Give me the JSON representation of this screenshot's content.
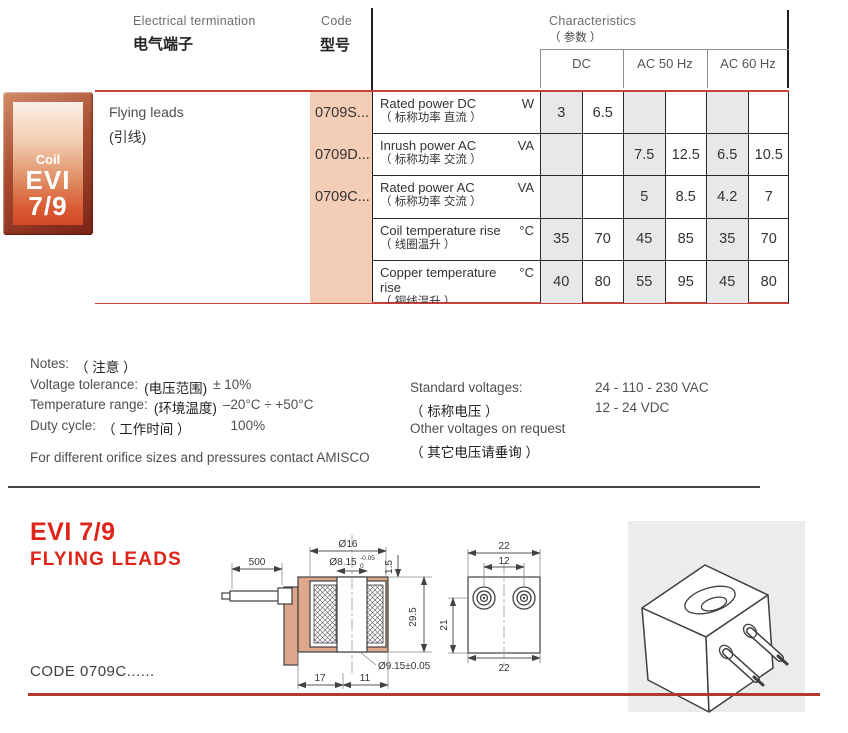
{
  "header": {
    "electrical_termination_en": "Electrical termination",
    "electrical_termination_zh": "电气端子",
    "code_en": "Code",
    "code_zh": "型号",
    "characteristics_en": "Characteristics",
    "characteristics_zh": "（ 参数 ）",
    "columns": [
      "DC",
      "AC 50 Hz",
      "AC 60 Hz"
    ]
  },
  "badge": {
    "line1": "Coil",
    "line2": "EVI",
    "line3": "7/9"
  },
  "table": {
    "termination_en": "Flying leads",
    "termination_zh": "(引线)",
    "codes": [
      "0709S...",
      "0709D...",
      "0709C..."
    ],
    "rows": [
      {
        "en": "Rated power DC",
        "zh": "（ 标称功率 直流 ）",
        "unit": "W",
        "values": [
          "3",
          "6.5",
          "",
          "",
          "",
          ""
        ]
      },
      {
        "en": "Inrush power AC",
        "zh": "（ 标称功率 交流 ）",
        "unit": "VA",
        "values": [
          "",
          "",
          "7.5",
          "12.5",
          "6.5",
          "10.5"
        ]
      },
      {
        "en": "Rated power AC",
        "zh": "（ 标称功率 交流 ）",
        "unit": "VA",
        "values": [
          "",
          "",
          "5",
          "8.5",
          "4.2",
          "7"
        ]
      },
      {
        "en": "Coil temperature rise",
        "zh": "（ 线圈温升 ）",
        "unit": "°C",
        "values": [
          "35",
          "70",
          "45",
          "85",
          "35",
          "70"
        ]
      },
      {
        "en": "Copper temperature rise",
        "zh": "（ 铜线温升 ）",
        "unit": "°C",
        "values": [
          "40",
          "80",
          "55",
          "95",
          "45",
          "80"
        ]
      }
    ]
  },
  "notes": {
    "label_en": "Notes:",
    "label_zh": "（ 注意 ）",
    "voltage_en": "Voltage tolerance:",
    "voltage_zh": "(电压范围)",
    "voltage_val": "± 10%",
    "temp_en": "Temperature range:",
    "temp_zh": "(环境温度)",
    "temp_val": "–20°C ÷ +50°C",
    "duty_en": "Duty cycle:",
    "duty_zh": "（ 工作时间 ）",
    "duty_val": "100%",
    "contact": "For different orifice sizes and pressures contact AMISCO",
    "std_en": "Standard voltages:",
    "std_zh": "（ 标称电压 ）",
    "std_vac": "24 - 110 - 230 VAC",
    "std_vdc": "12 - 24 VDC",
    "other_en": "Other voltages on request",
    "other_zh": "（ 其它电压请垂询 ）"
  },
  "section": {
    "title_line1": "EVI 7/9",
    "title_line2": "FLYING LEADS",
    "code_caption": "CODE 0709C......"
  },
  "drawing": {
    "lead_length": "500",
    "coil_dia": "Ø16",
    "top_dia": "Ø8.15",
    "top_dia_tol_upper": "-0.05",
    "top_dia_tol_lower": "0",
    "step_height": "1.5",
    "coil_height": "29.5",
    "bottom_dia": "Ø9.15±0.05",
    "base_left": "17",
    "base_right": "11",
    "front_top_width": "22",
    "front_pin_pitch": "12",
    "front_pin_height": "21",
    "front_bottom_width": "22"
  }
}
